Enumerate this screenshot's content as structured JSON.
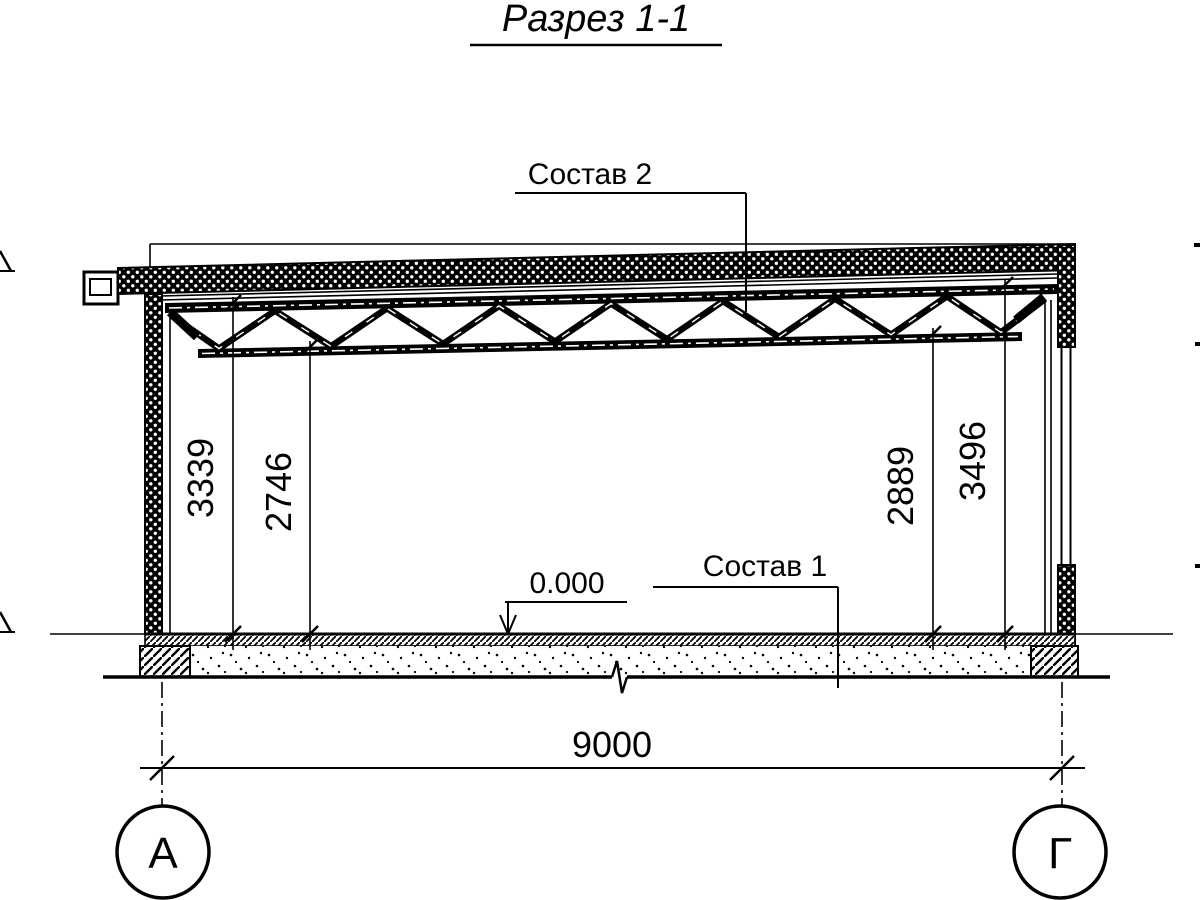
{
  "title": "Разрез 1-1",
  "labels": {
    "roof_composition": "Состав 2",
    "floor_composition": "Состав 1",
    "floor_level": "0.000"
  },
  "dimensions": {
    "left_outer": "3339",
    "left_inner": "2746",
    "right_inner": "2889",
    "right_outer": "3496",
    "span": "9000"
  },
  "axes": {
    "left": "А",
    "right": "Г"
  },
  "colors": {
    "ink": "#000000",
    "background": "#ffffff"
  }
}
